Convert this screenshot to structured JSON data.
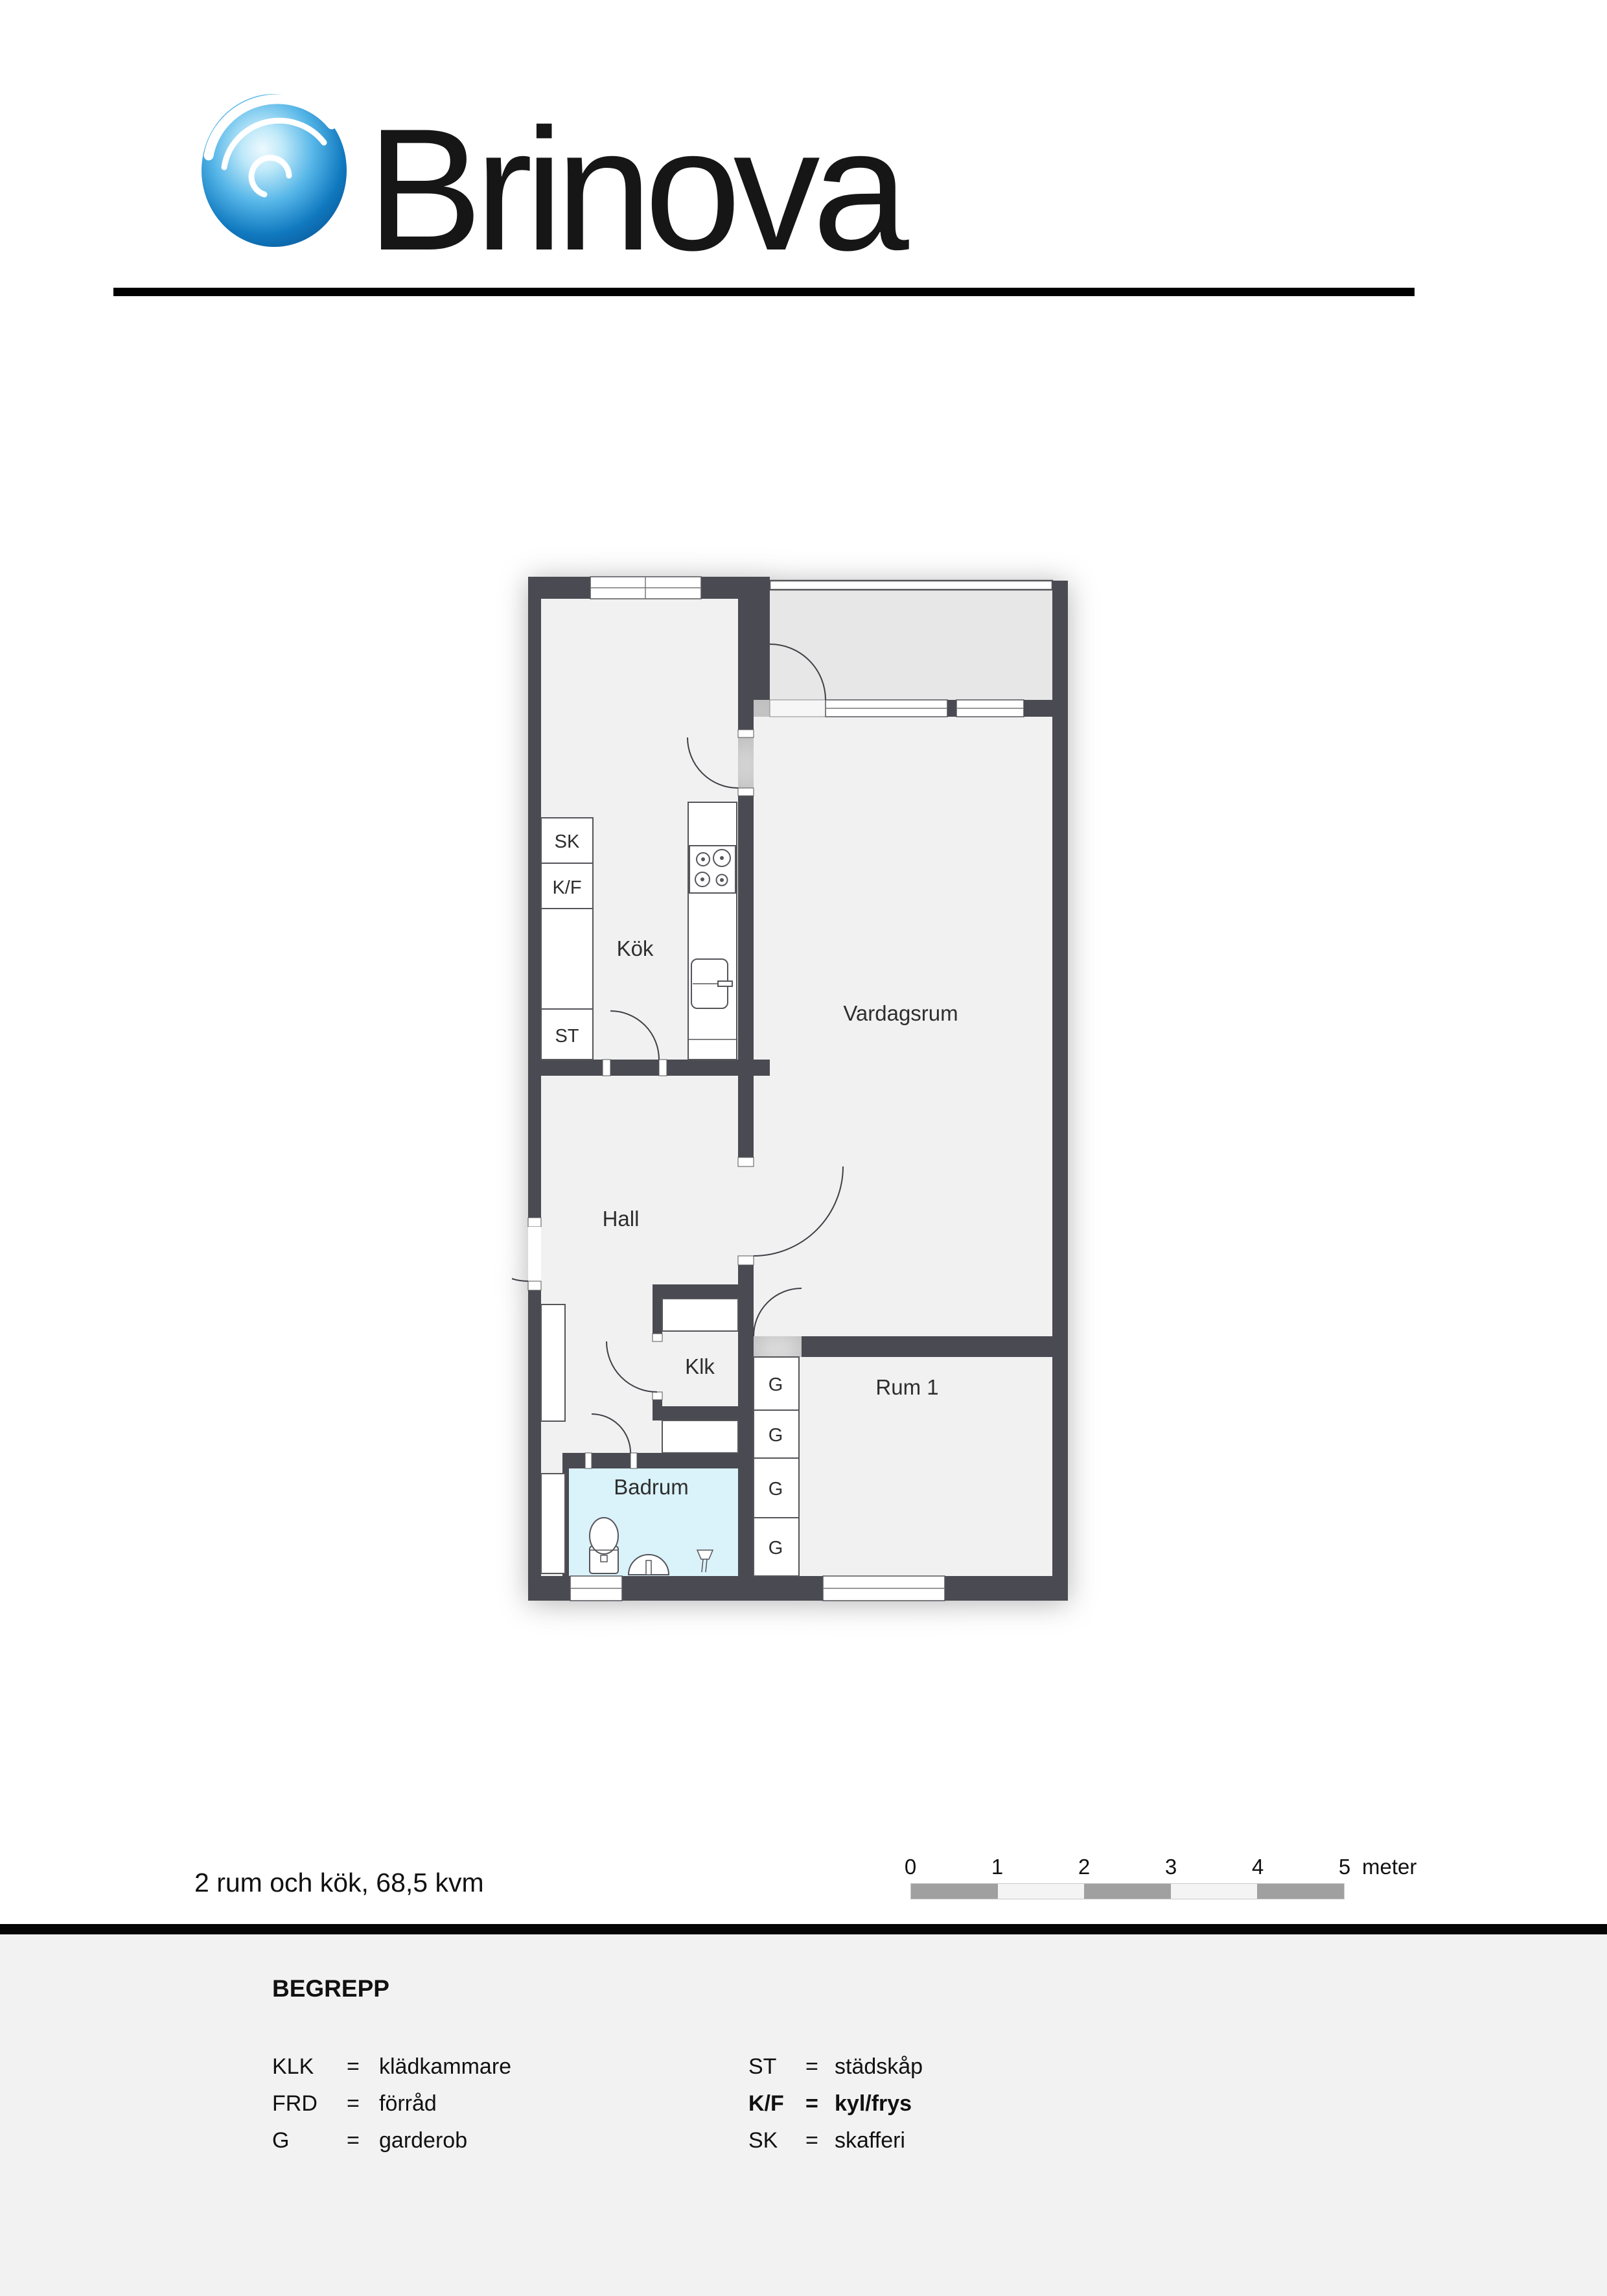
{
  "brand": {
    "name": "Brinova"
  },
  "floorplan": {
    "rooms": {
      "kitchen": "Kök",
      "living": "Vardagsrum",
      "hall": "Hall",
      "closet": "Klk",
      "bathroom": "Badrum",
      "room1": "Rum 1"
    },
    "cabinets": {
      "sk": "SK",
      "kf": "K/F",
      "st": "ST"
    },
    "wardrobes": [
      "G",
      "G",
      "G",
      "G"
    ]
  },
  "summary": {
    "title": "2 rum och kök, 68,5 kvm"
  },
  "scalebar": {
    "ticks": [
      "0",
      "1",
      "2",
      "3",
      "4",
      "5"
    ],
    "unit": "meter"
  },
  "legend": {
    "heading": "BEGREPP",
    "left": [
      {
        "abbr": "KLK",
        "eq": "=",
        "def": "klädkammare"
      },
      {
        "abbr": "FRD",
        "eq": "=",
        "def": "förråd"
      },
      {
        "abbr": "G",
        "eq": "=",
        "def": "garderob"
      }
    ],
    "right": [
      {
        "abbr": "ST",
        "eq": "=",
        "def": "städskåp"
      },
      {
        "abbr": "K/F",
        "eq": "=",
        "def": "kyl/frys"
      },
      {
        "abbr": "SK",
        "eq": "=",
        "def": "skafferi"
      }
    ]
  },
  "colors": {
    "wall": "#4a4a52",
    "room": "#f1f1f1",
    "balcony": "#e7e7e7",
    "bathroom": "#daf2fa",
    "scale_dark": "#a0a0a0",
    "scale_light": "#f4f4f4",
    "logo_blue": "#1079bf"
  }
}
